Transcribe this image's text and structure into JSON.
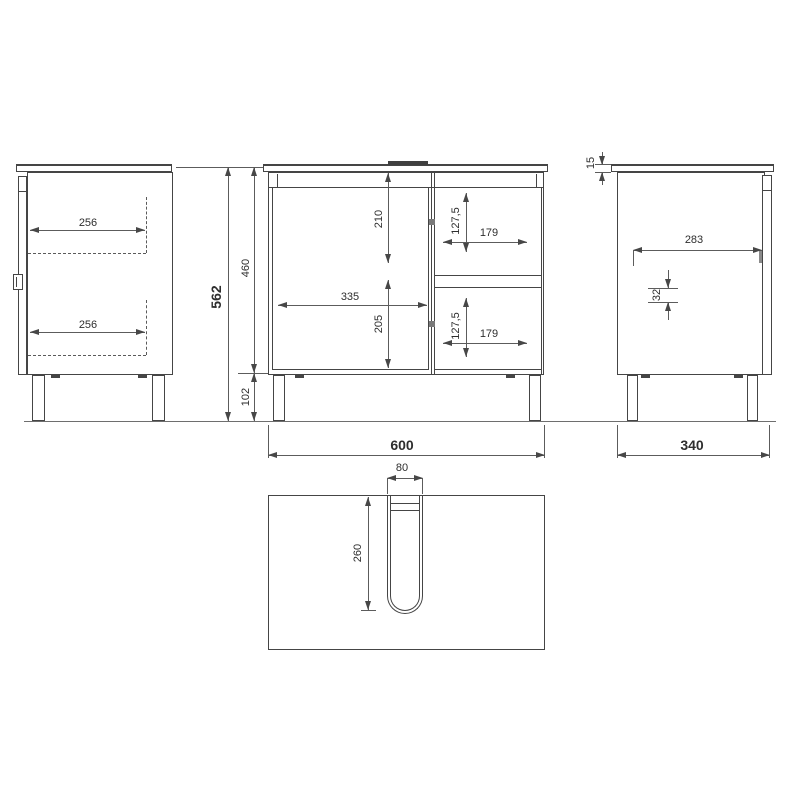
{
  "dims": {
    "total_height": "562",
    "cabinet_height": "460",
    "leg_height": "102",
    "left_drawer_top_depth": "256",
    "left_drawer_bottom_depth": "256",
    "door_top_span": "210",
    "door_width": "335",
    "door_bottom_span": "205",
    "drawer_top_height": "127,5",
    "drawer_top_width": "179",
    "drawer_bottom_height": "127,5",
    "drawer_bottom_width": "179",
    "overall_width": "600",
    "top_thickness": "15",
    "side_inner_depth": "283",
    "side_offset": "32",
    "overall_depth": "340",
    "cutout_width": "80",
    "cutout_depth": "260"
  },
  "colors": {
    "line": "#454545",
    "dimension_line": "#5c5c5c",
    "text": "#2e2e2e",
    "background": "#ffffff"
  }
}
